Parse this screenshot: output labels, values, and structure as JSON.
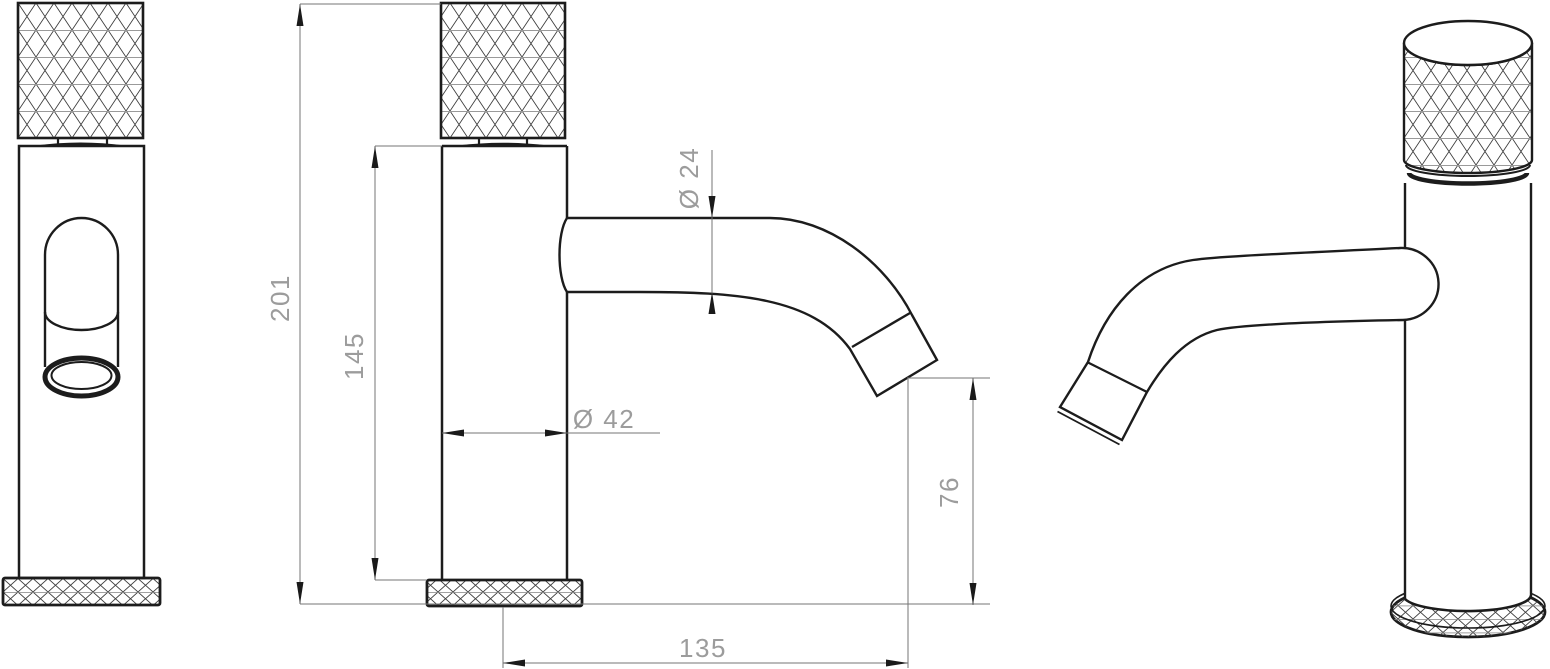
{
  "drawing": {
    "background": "#ffffff",
    "outline_color": "#1c1c1c",
    "dim_line_color": "#757575",
    "arrow_color": "#1a1a1a",
    "dim_text_color": "#9c9c9c",
    "dimensions": {
      "overall_height": "201",
      "spout_height": "145",
      "spout_diameter": "Ø 24",
      "body_diameter": "Ø 42",
      "outlet_height": "76",
      "spout_reach": "135"
    }
  }
}
